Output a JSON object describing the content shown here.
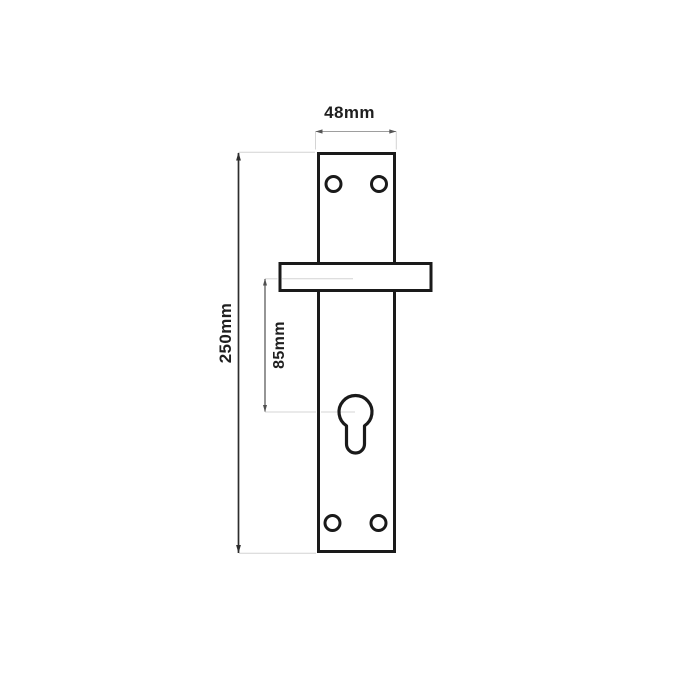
{
  "drawing": {
    "subject": "door-handle-backplate-technical-drawing",
    "labels": {
      "width": "48mm",
      "height": "250mm",
      "handle_to_cylinder": "85mm"
    },
    "values_mm": {
      "width": 48,
      "height": 250,
      "handle_to_cylinder": 85
    },
    "features": {
      "screw_holes": 4,
      "keyhole_type": "euro-cylinder",
      "handle_section": "horizontal-stem-through-plate"
    },
    "colors": {
      "background": "#ffffff",
      "outline": "#1a1a1a",
      "dimension_primary": "#2d2d2d",
      "dimension_secondary": "#4f4f4f",
      "dimension_width_line": "#9e9e9e",
      "dimension_width_arrow": "#555555",
      "extension_line": "#d4d4d4",
      "label_text": "#1f1f1f"
    }
  }
}
